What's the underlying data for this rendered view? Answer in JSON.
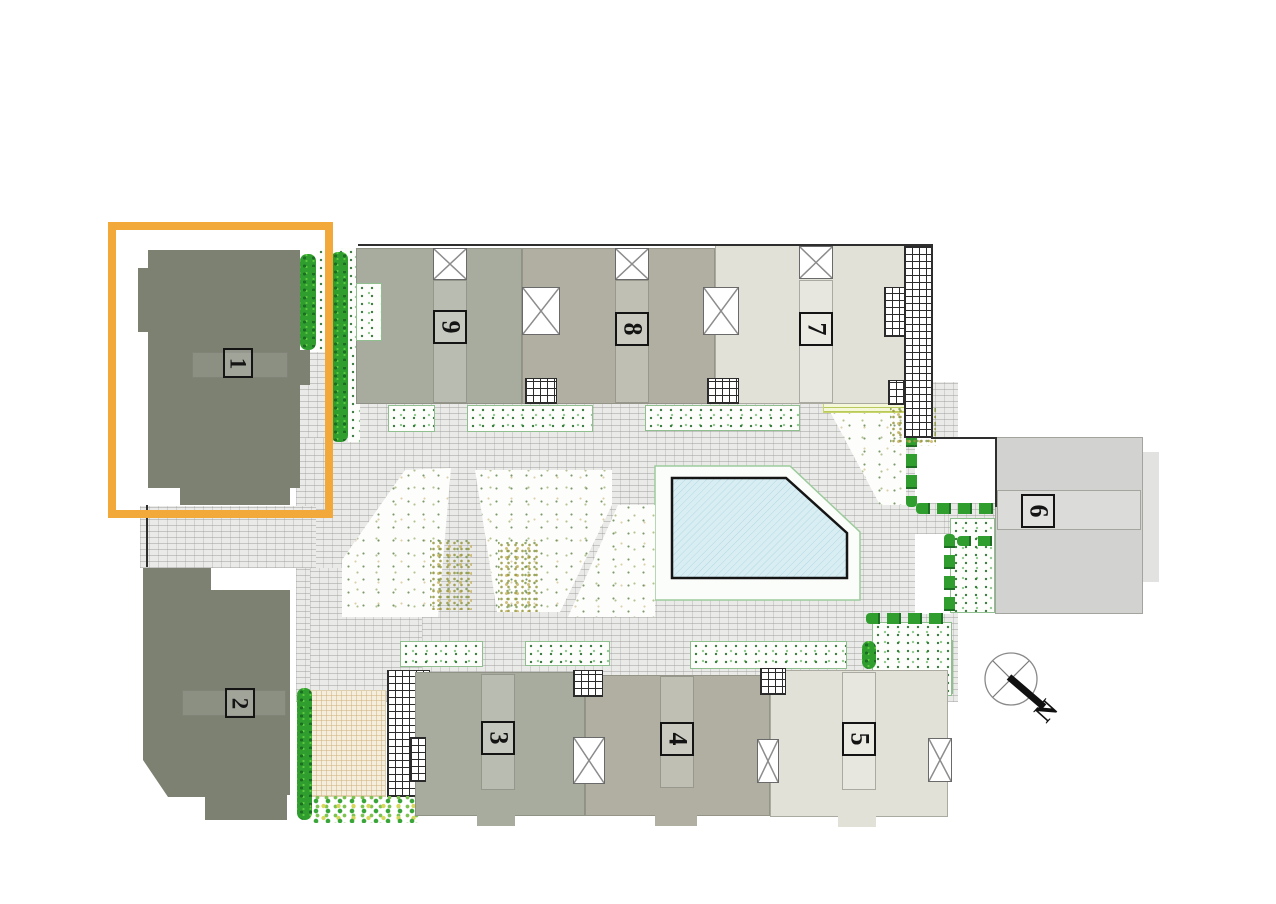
{
  "plan": {
    "type": "residential-site-plan",
    "buildings": [
      {
        "label": "1",
        "highlighted": true
      },
      {
        "label": "2",
        "highlighted": false
      },
      {
        "label": "3",
        "highlighted": false
      },
      {
        "label": "4",
        "highlighted": false
      },
      {
        "label": "5",
        "highlighted": false
      },
      {
        "label": "6",
        "highlighted": false
      },
      {
        "label": "7",
        "highlighted": false
      },
      {
        "label": "8",
        "highlighted": false
      },
      {
        "label": "9",
        "highlighted": false
      }
    ],
    "compass": {
      "north_label": "N"
    },
    "highlight": {
      "building": "1",
      "color": "#F3A83A"
    },
    "colors": {
      "dark_block": "#7D8172",
      "mid_block": "#A8AC9E",
      "tan_block": "#B1AFA1",
      "light_block": "#E2E1D7",
      "block_6": "#D2D2D1",
      "pool_water": "#D9EEF3",
      "hedge_green": "#2F9E2F",
      "paving": "#EAEAE9",
      "highlight": "#F3A83A"
    }
  }
}
